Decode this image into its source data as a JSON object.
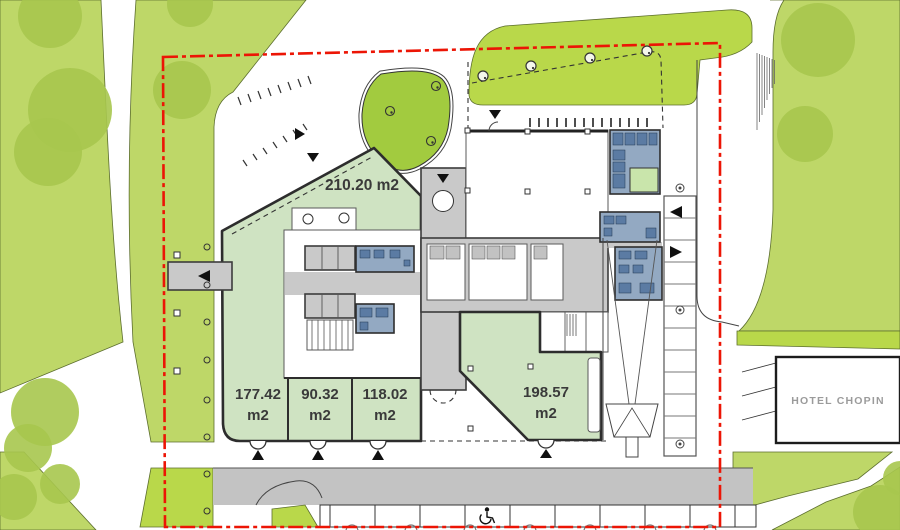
{
  "plan": {
    "units": [
      {
        "label": "210.20 m2"
      },
      {
        "value": "177.42",
        "unit": "m2"
      },
      {
        "value": "90.32",
        "unit": "m2"
      },
      {
        "value": "118.02",
        "unit": "m2"
      },
      {
        "value": "198.57",
        "unit": "m2"
      }
    ],
    "hotel": {
      "label": "HOTEL CHOPIN"
    }
  },
  "icons": {
    "trees": "tree-icon",
    "entrance_arrows": "entrance-arrow-icon",
    "disabled_parking": "wheelchair-icon"
  },
  "colors": {
    "lawn": "#bed768",
    "tree_green": "#a7c74e",
    "bright_lawn": "#b9d84a",
    "island_green": "#a2cb3f",
    "unit_green": "#cfe3c2",
    "room_green": "#c9e5ab",
    "blue_room": "#93a9c2",
    "blue_dark": "#5b7ba3",
    "core_gray": "#c9c9c9",
    "road_gray": "#c3c3c3",
    "wall_dark": "#2d2d2d",
    "boundary_red": "#ec1505",
    "hotel_text": "#9b9b9b"
  }
}
